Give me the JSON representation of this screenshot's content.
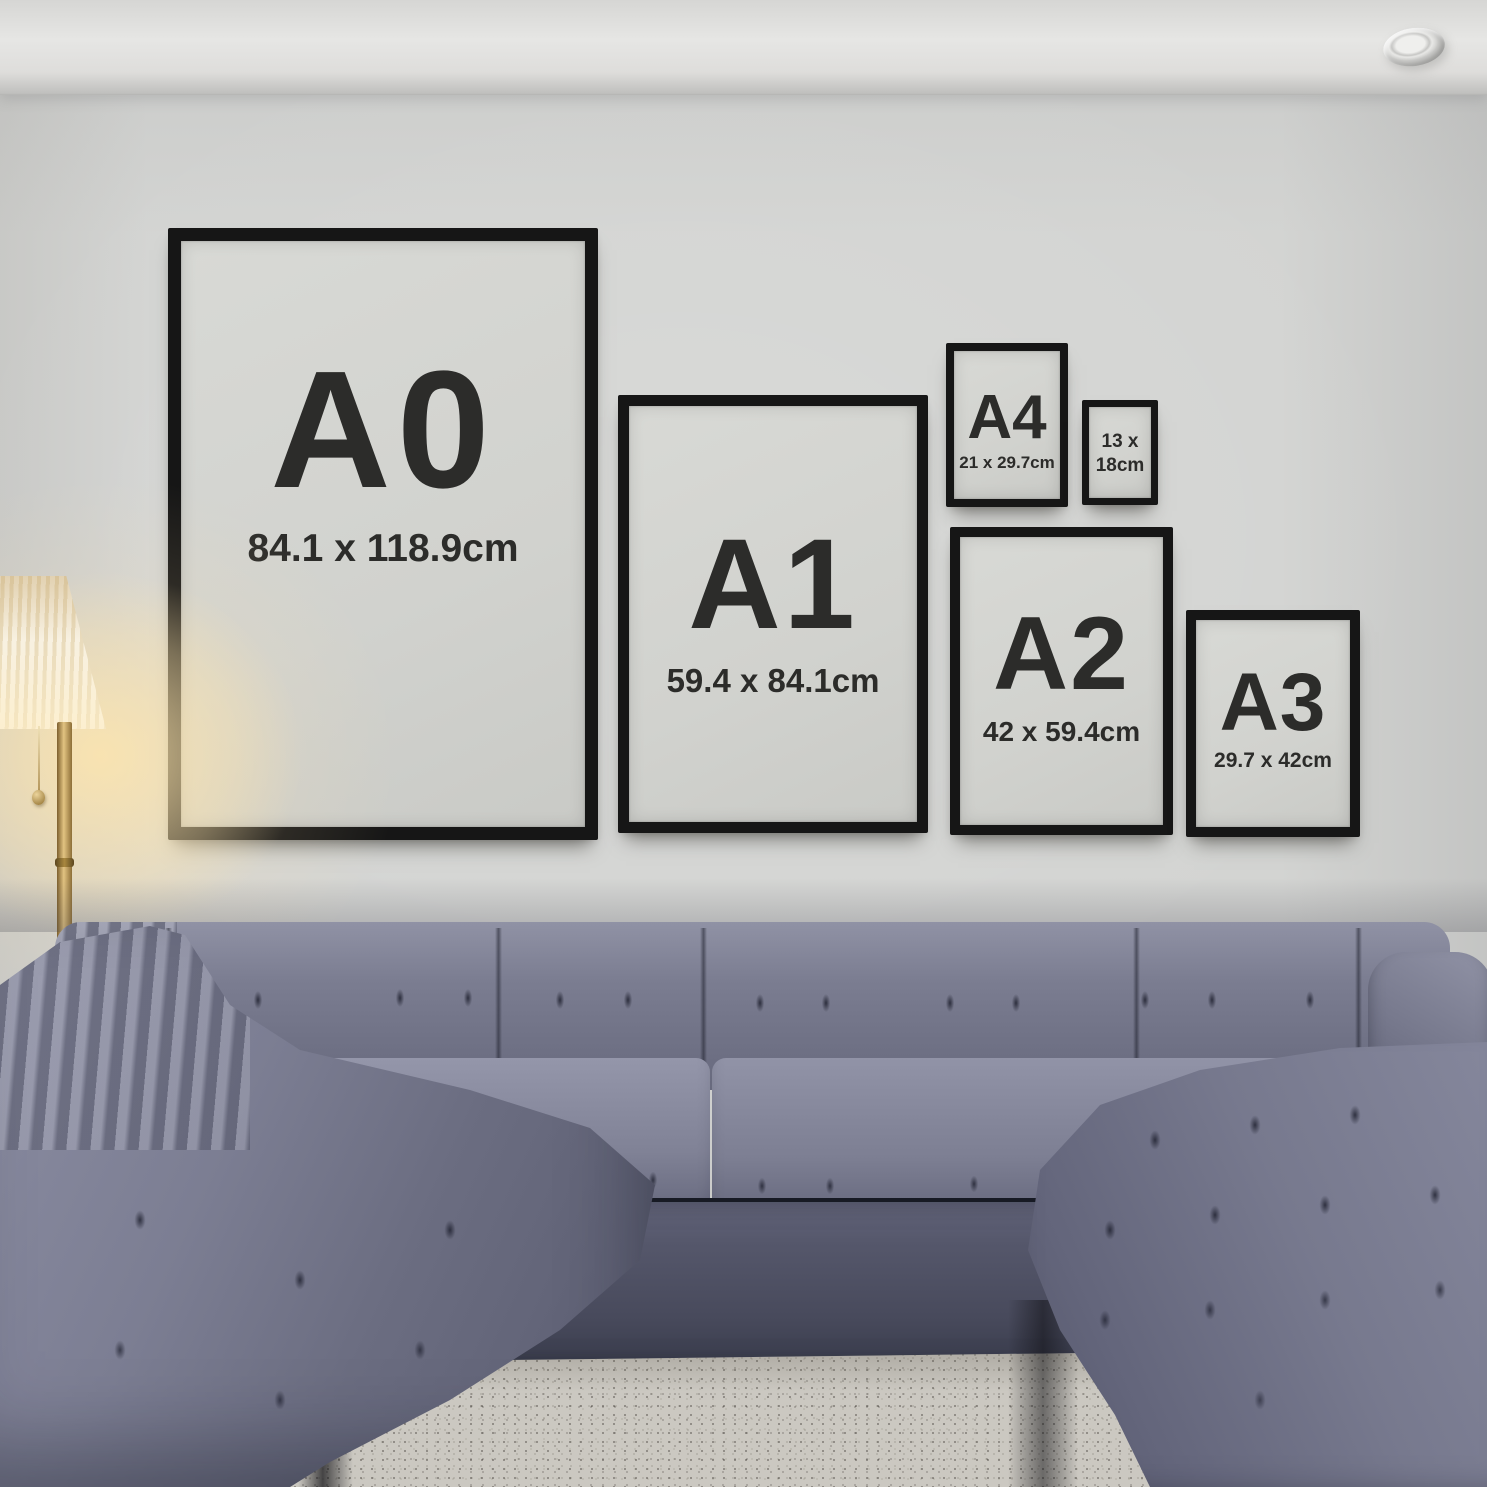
{
  "frames": [
    {
      "id": "a0",
      "label": "A0",
      "size": "84.1 x 118.9cm"
    },
    {
      "id": "a1",
      "label": "A1",
      "size": "59.4 x 84.1cm"
    },
    {
      "id": "a4",
      "label": "A4",
      "size": "21 x 29.7cm"
    },
    {
      "id": "13x18",
      "label": "13 x",
      "size": "18cm"
    },
    {
      "id": "a2",
      "label": "A2",
      "size": "42 x 59.4cm"
    },
    {
      "id": "a3",
      "label": "A3",
      "size": "29.7 x 42cm"
    }
  ],
  "colors": {
    "frame_border": "#161616",
    "poster_mat": "#d2d3cf",
    "poster_text": "#2c2c2a",
    "wall": "#d3d4d2",
    "ceiling": "#e0e0de",
    "sofa_fabric": "#72748a",
    "sofa_shadow": "#3f4252",
    "rug": "#ccc9c2",
    "floor": "#3a2418",
    "lamp_shade": "#f4ecd9",
    "lamp_metal": "#b08f52",
    "lamp_glow": "#ffe4a8"
  }
}
